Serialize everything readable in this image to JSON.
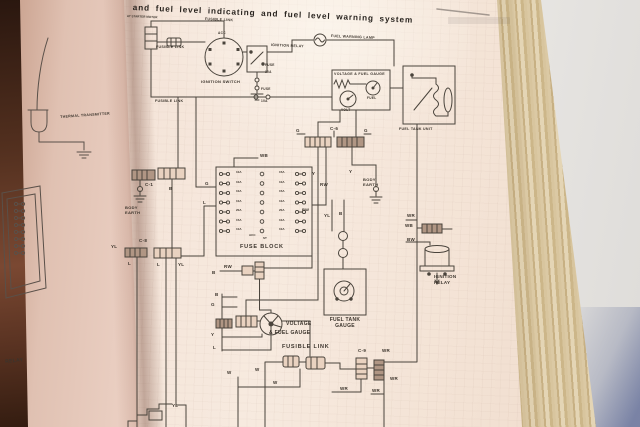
{
  "page": {
    "title": "and fuel level indicating and fuel level warning system",
    "subtitle_small": "AT STARTER MOTOR"
  },
  "left_page": {
    "thermal_transmitter": "THERMAL TRANSMITTER",
    "relay_partial": "RELAY"
  },
  "diagram": {
    "labels": {
      "fusible_link": "FUSIBLE LINK",
      "ignition_switch": "IGNITION SWITCH",
      "acc": "ACC",
      "ignition_relay": "IGNITION RELAY",
      "ignition_relay_stacked": "IGNITION\nRELAY",
      "fuse": "FUSE",
      "amp10": "10A",
      "fuel_warning_lamp": "FUEL WARNING LAMP",
      "voltage_fuel_gauge": "VOLTAGE & FUEL GAUGE",
      "voltage": "VOLTAGE",
      "and_fuel_gauge": "& FUEL GAUGE",
      "fuel": "FUEL",
      "volt": "VOLT",
      "fuel_tank_unit": "FUEL TANK UNIT",
      "fuel_tank_gauge": "FUEL TANK\nGAUGE",
      "fuse_block": "FUSE BLOCK",
      "body_earth": "BODY\nEARTH",
      "c1": "C-1",
      "c6": "C-6",
      "c8": "C-8",
      "c9": "C-9",
      "st": "ST",
      "g": "G",
      "l": "L",
      "b": "B",
      "y": "Y",
      "yl": "YL",
      "rw": "RW",
      "wb": "WB",
      "wr": "WR",
      "bw": "BW",
      "w": "W"
    },
    "fuse_block": {
      "left_column": [
        "10A",
        "10A",
        "10A",
        "10A",
        "20A",
        "15A",
        "10A"
      ],
      "right_column": [
        "15A",
        "10A",
        "15A",
        "10A",
        "20A",
        "10A",
        "10A"
      ]
    }
  },
  "colors": {
    "paper": "#f4e3d7",
    "paper_left": "#eed4c8",
    "ink": "#4a443c",
    "cover": "#53301f",
    "page_edge": "#d5c29c",
    "background": "#e1dfdc",
    "shadow_blue": "#6873a0"
  }
}
